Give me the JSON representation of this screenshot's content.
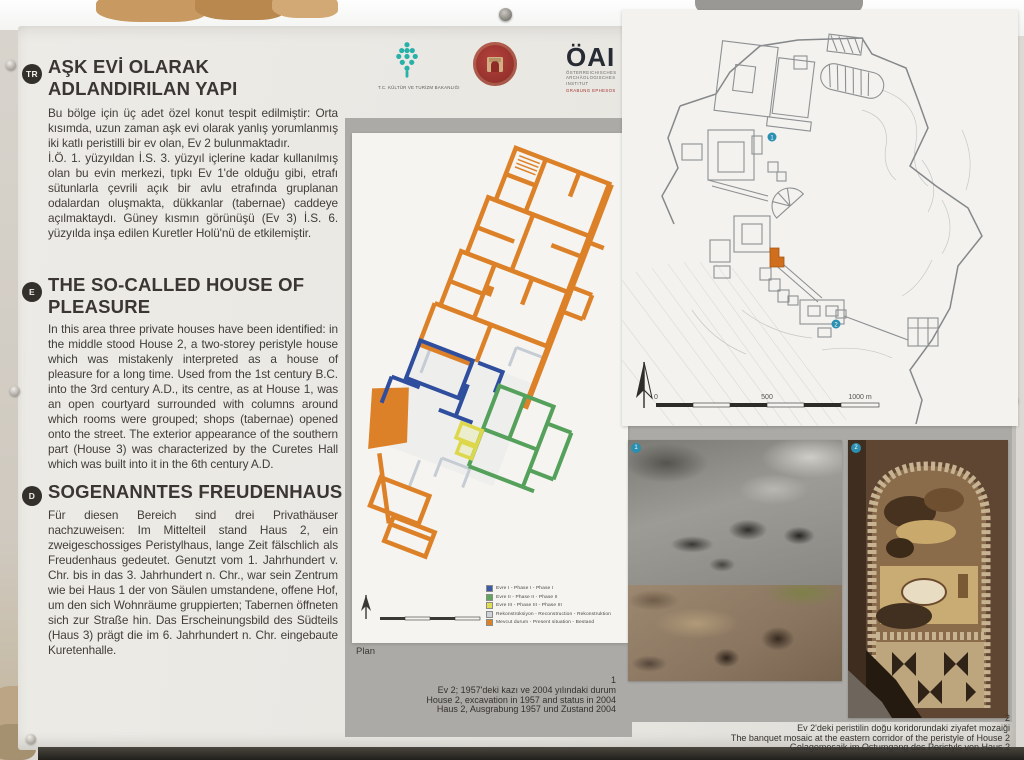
{
  "sections": [
    {
      "badge": "TR",
      "title": "AŞK EVİ OLARAK\nADLANDIRILAN YAPI",
      "body": "Bu bölge için üç adet özel konut tespit edilmiştir: Orta kısımda, uzun zaman aşk evi olarak yanlış yorumlanmış iki katlı peristilli bir ev olan, Ev 2 bulunmaktadır.\nİ.Ö. 1. yüzyıldan İ.S. 3. yüzyıl içlerine kadar kullanılmış olan bu evin merkezi, tıpkı Ev 1'de olduğu gibi, etrafı sütunlarla çevrili açık bir avlu etrafında gruplanan odalardan oluşmakta, dükkanlar (tabernae) caddeye açılmaktaydı. Güney kısmın görünüşü (Ev 3) İ.S. 6. yüzyılda inşa edilen Kuretler Holü'nü de etkilemiştir."
    },
    {
      "badge": "E",
      "title": "THE SO-CALLED HOUSE OF\nPLEASURE",
      "body": "In this area three private houses have been identified: in the middle stood House 2, a two-storey peristyle house which was mistakenly interpreted as a house of pleasure for a long time. Used from the 1st century B.C. into the 3rd century A.D., its centre, as at House 1, was an open courtyard surrounded with columns around which rooms were grouped; shops (tabernae) opened onto the street. The exterior appearance of the southern part (House 3) was characterized by the Curetes Hall which was built into it in the 6th century A.D."
    },
    {
      "badge": "D",
      "title": "SOGENANNTES FREUDENHAUS",
      "body": "Für diesen Bereich sind drei Privathäuser nachzuweisen: Im Mittelteil stand Haus 2, ein zweigeschossiges Peristylhaus, lange Zeit fälschlich als Freudenhaus gedeutet. Genutzt vom 1. Jahrhundert v. Chr. bis in das 3. Jahrhundert n. Chr., war sein Zentrum wie bei Haus 1 der von Säulen umstandene, offene Hof, um den sich Wohnräume gruppierten; Tabernen öffneten sich zur Straße hin. Das Erscheinungsbild des Südteils (Haus 3) prägt die im 6. Jahrhundert n. Chr. eingebaute Kuretenhalle."
    }
  ],
  "logos": {
    "ministry_caption": "T.C. KÜLTÜR VE TURİZM BAKANLIĞI",
    "ministry_color": "#27b1a8",
    "museum_color": "#a33531",
    "oai_title": "ÖAI",
    "oai_line1": "ÖSTERREICHISCHES",
    "oai_line2": "ARCHÄOLOGISCHES",
    "oai_line3": "INSTITUT",
    "oai_red_line": "GRABUNG EPHESOS"
  },
  "plan": {
    "label": "Plan",
    "accent_color": "#dd8128",
    "legend": [
      {
        "color": "#3b5aa8",
        "label": "Evre I - Phase I - Phase I"
      },
      {
        "color": "#5ea55e",
        "label": "Evre II - Phase II - Phase II"
      },
      {
        "color": "#dede52",
        "label": "Evre III - Phase III - Phase III"
      },
      {
        "color": "#ccd2da",
        "label": "Rekonstrüksiyon - Reconstruction - Rekonstruktion"
      },
      {
        "color": "#dd8128",
        "label": "Mevcut durum - Present situation - Bestand"
      }
    ]
  },
  "map": {
    "marker_color": "#2a8fb0",
    "scale": [
      "0",
      "500",
      "1000 m"
    ]
  },
  "photos": [
    {
      "number": "1",
      "caption_tr": "Ev 2; 1957'deki kazı ve 2004 yılındaki durum",
      "caption_en": "House 2, excavation in 1957 and status in 2004",
      "caption_de": "Haus 2, Ausgrabung 1957 und Zustand 2004"
    },
    {
      "number": "2",
      "caption_tr": "Ev 2'deki peristilin doğu koridorundaki ziyafet mozaiği",
      "caption_en": "The banquet mosaic at the eastern corridor of the peristyle of House 2",
      "caption_de": "Gelagemosaik im Ostumgang des Peristyls von Haus 2"
    }
  ]
}
